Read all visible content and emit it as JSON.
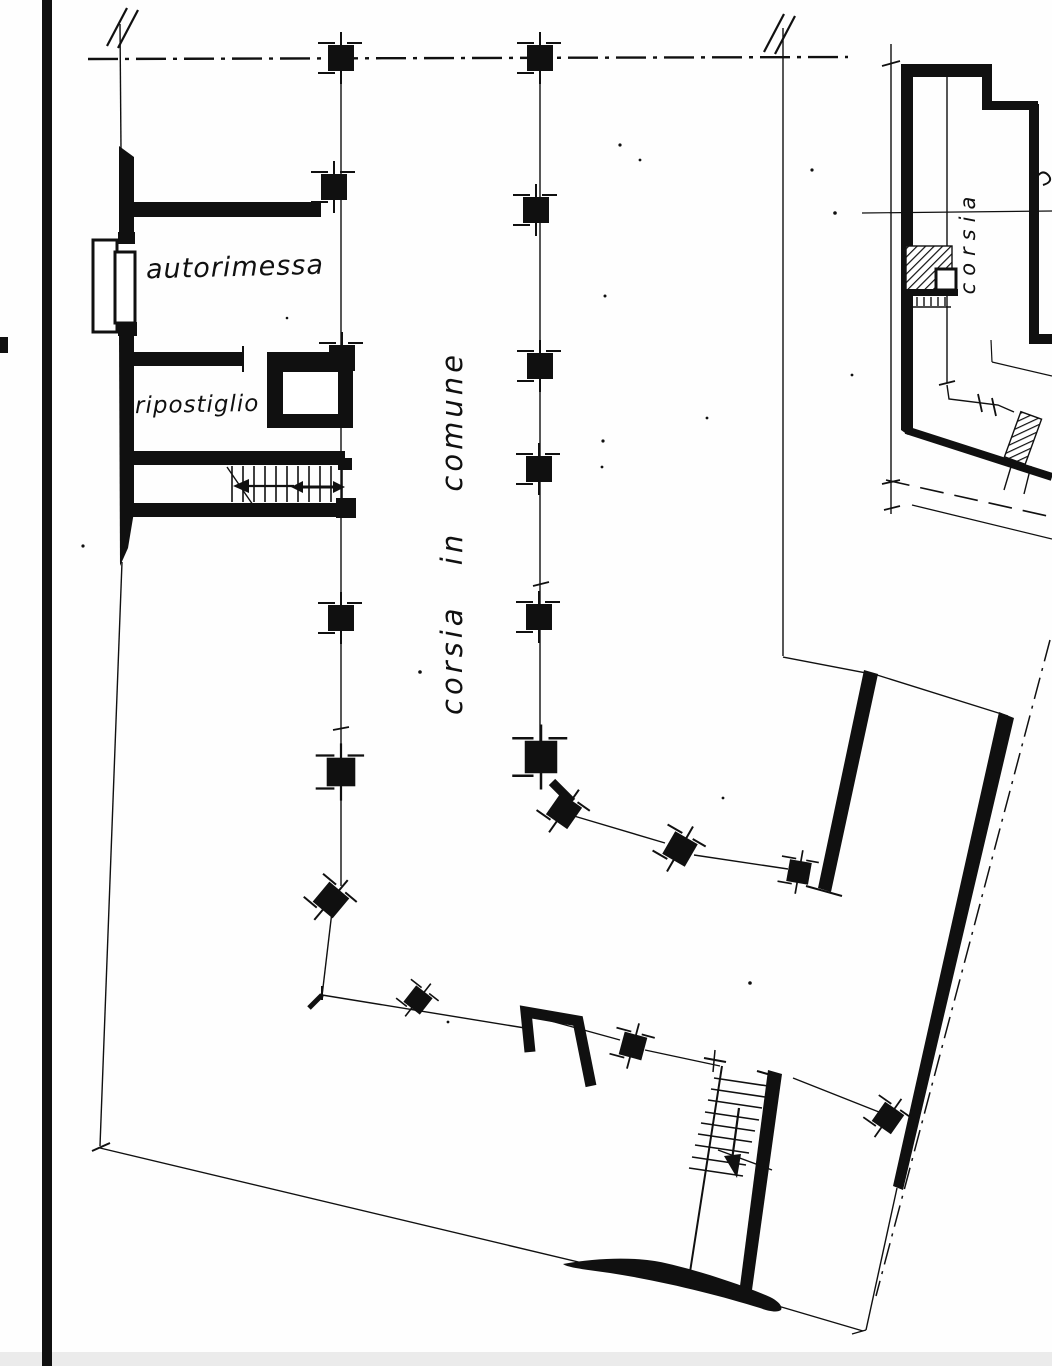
{
  "page": {
    "kind": "scanned hand-drawn architectural floor plan (basement / garage level)",
    "language": "Italian",
    "colors": {
      "ink": "#101010",
      "paper": "#fefefe",
      "scan_edge": "#ebebeb"
    }
  },
  "plan": {
    "room_labels": [
      {
        "id": "autorimessa",
        "text": "autorimessa"
      },
      {
        "id": "ripostiglio",
        "text": "ripostiglio"
      }
    ],
    "lane_label": {
      "text": "corsia in comune",
      "orientation": "vertical-bottom-to-top"
    },
    "features": [
      "property axis dash-dot line with break marks",
      "two column rows with square concrete pillars",
      "garage door symbol on left wall",
      "closed square shaft beside ripostiglio",
      "internal staircase with direction arrow",
      "lower external staircase with down arrow",
      "sloped site boundaries with dash-dot street line"
    ]
  },
  "inset": {
    "kind": "small key plan of upper level",
    "lane_label": {
      "text": "corsia",
      "orientation": "vertical-bottom-to-top"
    }
  }
}
